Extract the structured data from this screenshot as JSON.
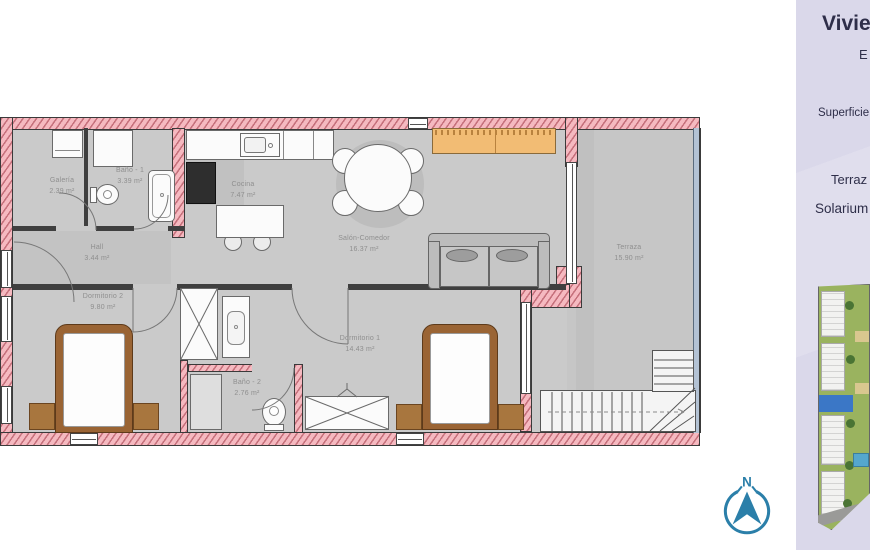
{
  "plan": {
    "rooms": [
      {
        "name": "Galería",
        "area": "2.39 m²"
      },
      {
        "name": "Baño - 1",
        "area": "3.39 m²"
      },
      {
        "name": "Cocina",
        "area": "7.47 m²"
      },
      {
        "name": "Hall",
        "area": "3.44 m²"
      },
      {
        "name": "Salón-Comedor",
        "area": "16.37 m²"
      },
      {
        "name": "Dormitorio 2",
        "area": "9.80 m²"
      },
      {
        "name": "Dormitorio 1",
        "area": "14.43 m²"
      },
      {
        "name": "Baño - 2",
        "area": "2.76 m²"
      },
      {
        "name": "Terraza",
        "area": "15.90 m²"
      }
    ],
    "compass_label": "N"
  },
  "side_panel": {
    "title_fragment": "Vivien",
    "subtitle_fragment": "E",
    "superficie_label": "Superficie",
    "terraza_label": "Terraz",
    "solarium_label": "Solarium"
  },
  "colors": {
    "wall_fill": "#f5b9c0",
    "wall_hatch": "#c76b76",
    "floor_gray": "#cacaca",
    "wood_brown": "#9a6434",
    "sideboard_orange": "#f2bc74",
    "compass_teal": "#2b7fa9",
    "panel_bg": "#dad8ea",
    "panel_text": "#2e2e49",
    "unit_marker_blue": "#3b77c6"
  }
}
